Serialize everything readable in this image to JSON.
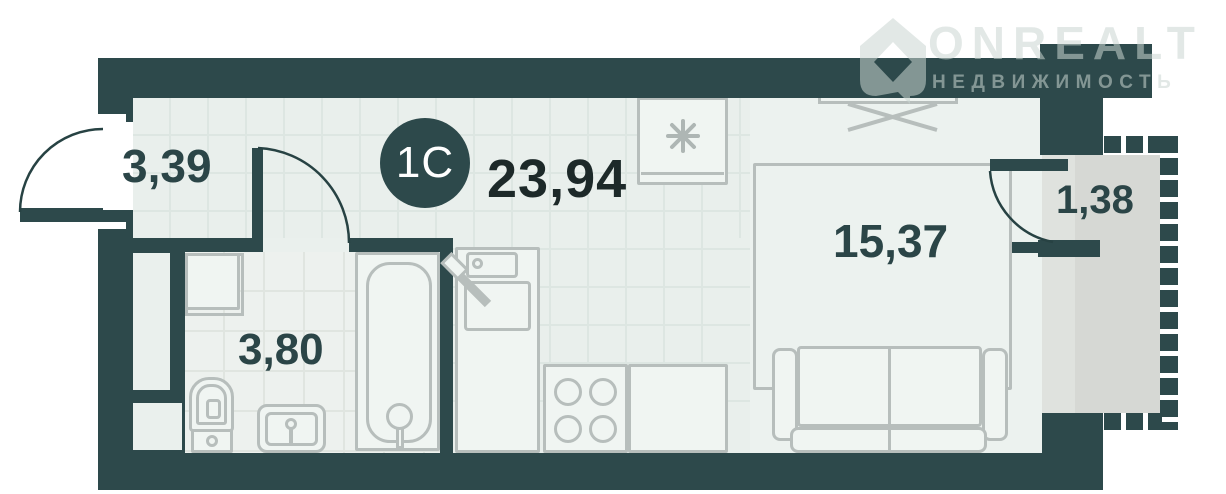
{
  "meta": {
    "type": "apartment-floor-plan",
    "unit_type": "studio"
  },
  "logo": {
    "brand": "ONREALT",
    "tagline": "НЕДВИЖИМОСТЬ"
  },
  "unit": {
    "badge": "1С",
    "total_area": "23,94"
  },
  "rooms": [
    {
      "id": "hallway",
      "area": "3,39"
    },
    {
      "id": "bathroom",
      "area": "3,80"
    },
    {
      "id": "living-room",
      "area": "15,37"
    },
    {
      "id": "balcony",
      "area": "1,38"
    }
  ],
  "icons": {
    "freezer": "asterisk-snowflake",
    "door_swing": "quarter-circle-arc",
    "balcony_glazing": "dashed-wall",
    "logo_mark": "house-pictogram"
  },
  "colors": {
    "wall": "#2d494b",
    "interior": "#eaf0ed",
    "living_room_floor": "#ecf2ef",
    "tile_line": "#dde6e2",
    "balcony_floor": "#d6d8d4",
    "balcony_sill": "#dfe2de",
    "furniture_line": "#b7bebc",
    "room_label": "#2b4547",
    "total_label": "#1d2929",
    "badge_bg": "#2d494b",
    "badge_text": "#ffffff",
    "watermark": "rgba(203,214,210,0.55)"
  }
}
